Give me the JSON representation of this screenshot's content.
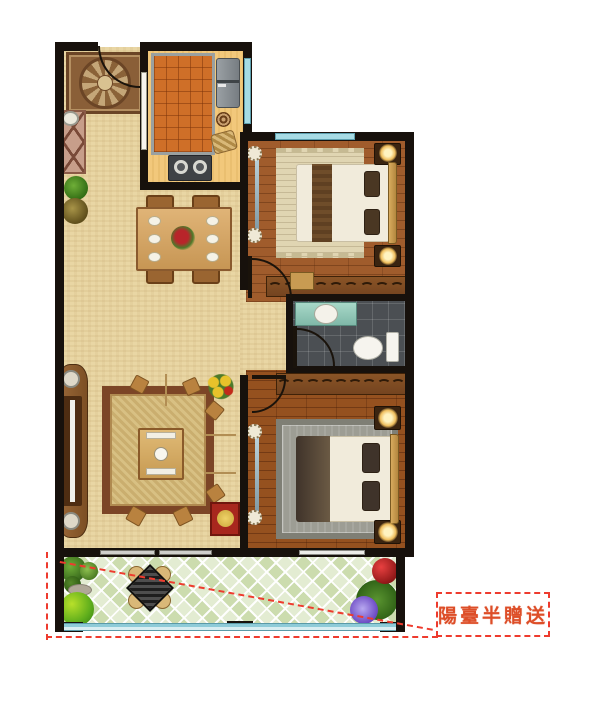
{
  "annotation": {
    "balcony_note": "陽臺半贈送"
  },
  "colors": {
    "annotation_red": "#ee3b2e",
    "annotation_text": "#dd4e28",
    "wall": "#17110c",
    "living_floor": "#e9d6a4",
    "kitchen_floor": "#f2c87b",
    "kitchen_parquet": "#cf6f28",
    "bedroom_floor": "#a05c2c",
    "master_floor": "#95511f",
    "bathroom_tile": "#4b4f53",
    "balcony_tile": "#dbe7c6",
    "window_glass": "#a7dbe4"
  }
}
